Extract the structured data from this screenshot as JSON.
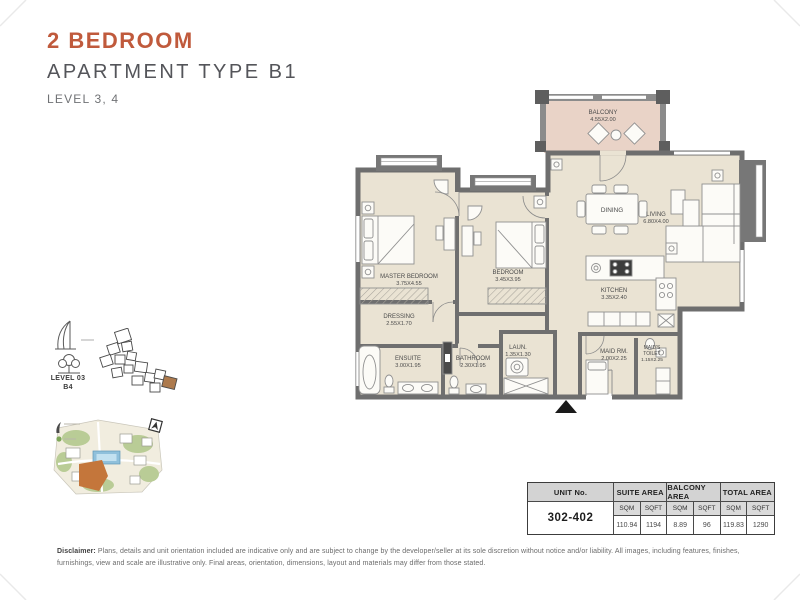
{
  "header": {
    "title": "2 BEDROOM",
    "subtitle": "APARTMENT TYPE B1",
    "level": "LEVEL 3, 4"
  },
  "keyplan": {
    "level": "LEVEL 03",
    "building": "B4"
  },
  "floorplan": {
    "balcony": {
      "name": "BALCONY",
      "dims": "4.55X2.00"
    },
    "dining": {
      "name": "DINING"
    },
    "living": {
      "name": "LIVING",
      "dims": "6.80X4.00"
    },
    "master": {
      "name": "MASTER BEDROOM",
      "dims": "3.75X4.55"
    },
    "bedroom": {
      "name": "BEDROOM",
      "dims": "3.45X3.95"
    },
    "dressing": {
      "name": "DRESSING",
      "dims": "2.55X1.70"
    },
    "ensuite": {
      "name": "ENSUITE",
      "dims": "3.00X1.95"
    },
    "bathroom": {
      "name": "BATHROOM",
      "dims": "2.30X1.95"
    },
    "laundry": {
      "name": "LAUN.",
      "dims": "1.35X1.30"
    },
    "kitchen": {
      "name": "KITCHEN",
      "dims": "3.35X2.40"
    },
    "maid": {
      "name": "MAID RM.",
      "dims": "2.00X2.25"
    },
    "maid_toilet": {
      "line1": "MAID'S",
      "line2": "TOILET",
      "dims": "1.15X2.25"
    }
  },
  "area_table": {
    "unit_header": "UNIT No.",
    "suite_header": "SUITE AREA",
    "balcony_header": "BALCONY AREA",
    "total_header": "TOTAL AREA",
    "sqm": "SQM",
    "sqft": "SQFT",
    "unit_no": "302-402",
    "suite_sqm": "110.94",
    "suite_sqft": "1194",
    "balcony_sqm": "8.89",
    "balcony_sqft": "96",
    "total_sqm": "119.83",
    "total_sqft": "1290"
  },
  "disclaimer": {
    "label": "Disclaimer:",
    "text": "Plans, details and unit orientation included are indicative only and are subject to change by the developer/seller at its sole discretion without notice and/or liability. All images, including features, finishes, furnishings, view and scale are illustrative only. Final areas, orientation, dimensions, layout and materials may differ from those stated."
  },
  "colors": {
    "accent": "#C05A3C",
    "wall": "#6E6E6E",
    "floor": "#EAE3D3",
    "balcony_floor": "#E9D3C7",
    "keyplan_highlight": "#AD7A4D",
    "parcel_highlight": "#C4763B"
  }
}
